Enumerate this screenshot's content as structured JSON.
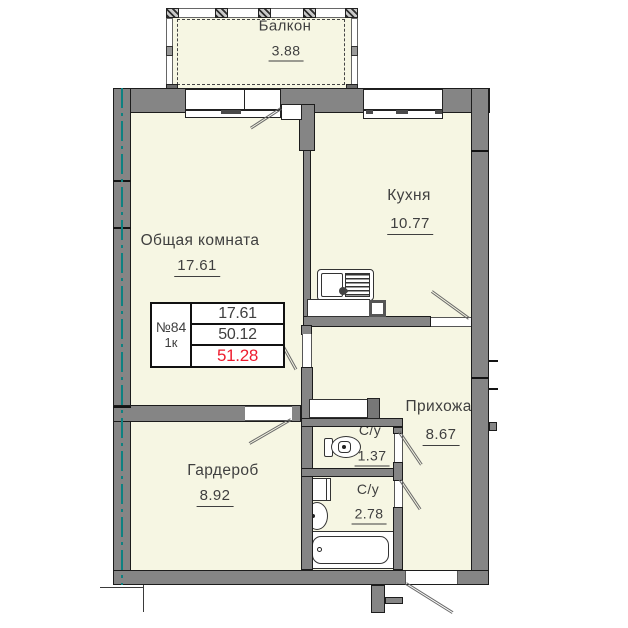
{
  "plan_title": "floor-plan-apartment-84",
  "colors": {
    "room_fill": "#f6f6e3",
    "wall": "#858585",
    "axis_teal": "#0e8181",
    "total_area_red": "#ee1c2e",
    "text": "#3f3f3f"
  },
  "rooms": [
    {
      "id": "balcony",
      "name": "Балкон",
      "area": "3.88"
    },
    {
      "id": "living",
      "name": "Общая комната",
      "area": "17.61"
    },
    {
      "id": "kitchen",
      "name": "Кухня",
      "area": "10.77"
    },
    {
      "id": "hallway",
      "name": "Прихожая",
      "area": "8.67"
    },
    {
      "id": "wardrobe",
      "name": "Гардероб",
      "area": "8.92"
    },
    {
      "id": "wc1",
      "name": "С/у",
      "area": "1.37"
    },
    {
      "id": "wc2",
      "name": "С/у",
      "area": "2.78"
    }
  ],
  "stamp": {
    "number": "№84",
    "unit_type": "1к",
    "living_area": "17.61",
    "area_without_balcony": "50.12",
    "total_area": "51.28"
  }
}
